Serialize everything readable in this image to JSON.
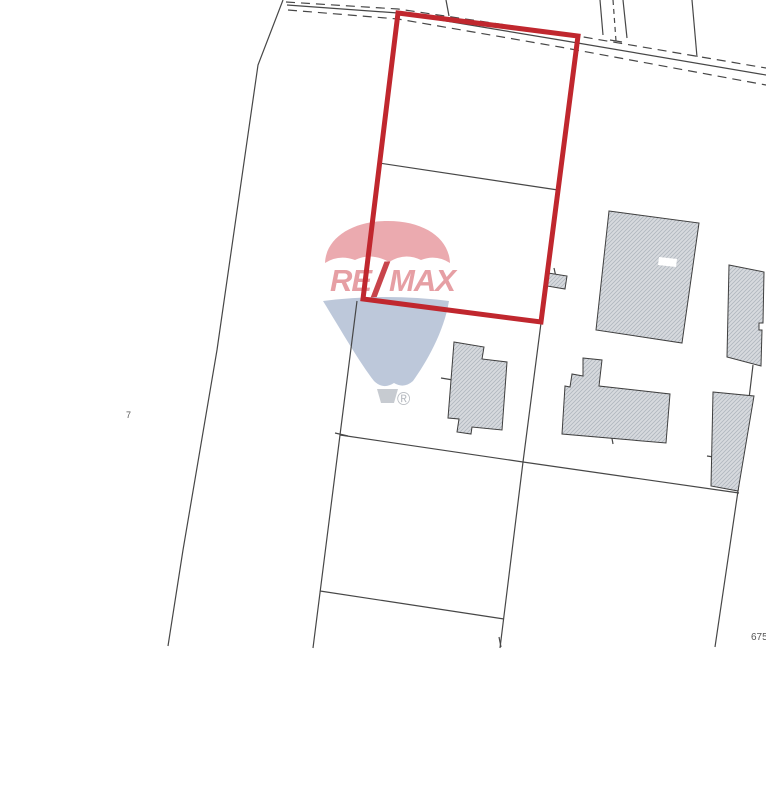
{
  "page": {
    "type": "cadastral-map-scan",
    "background": "#ffffff"
  },
  "map": {
    "labels": {
      "parcel_left": "7",
      "parcel_bottom_right": "675"
    },
    "colors": {
      "highlight_red": "#c0272e",
      "line_dark": "#474747",
      "building_fill": "#d7dade",
      "building_hatch": "#b0b6be",
      "building_outline": "#3f3f3f",
      "label_gray": "#5a5a5a"
    }
  },
  "watermark": {
    "brand_re": "RE",
    "brand_slash": "/",
    "brand_max": "MAX",
    "registered": "®",
    "colors": {
      "balloon_red": "#eaa6ab",
      "balloon_blue": "#bac6d9",
      "slash_red": "#c63a42",
      "letters_pink": "#e59aa0",
      "basket_gray": "#c5c9cf",
      "registered_gray": "#b5b9bf"
    }
  }
}
